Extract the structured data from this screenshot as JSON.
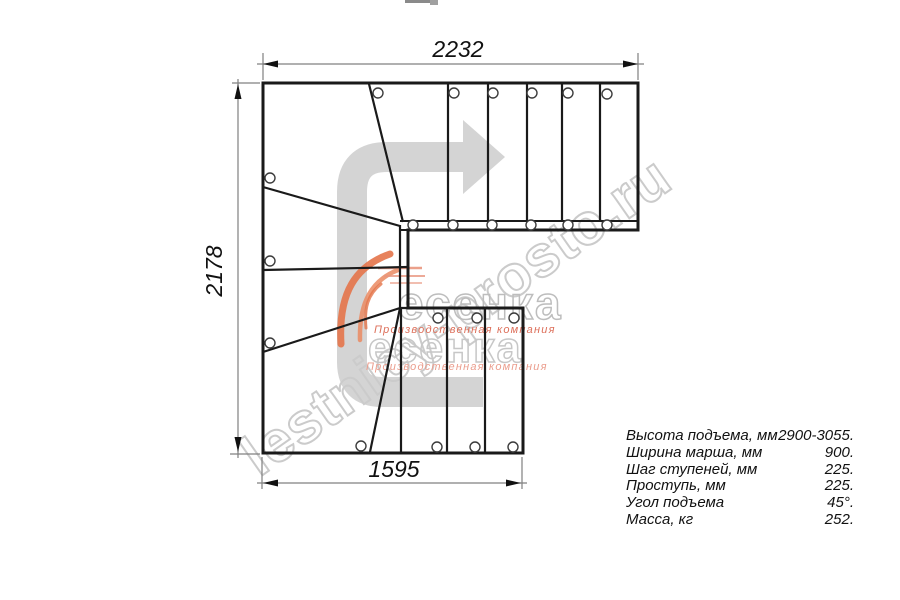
{
  "dimensions": {
    "top": "2232",
    "left": "2178",
    "bottom": "1595"
  },
  "specs": {
    "rows": [
      {
        "label": "Высота подъема, мм",
        "value": "2900-3055."
      },
      {
        "label": "Ширина марша, мм",
        "value": "900."
      },
      {
        "label": "Шаг ступеней, мм",
        "value": "225."
      },
      {
        "label": "Проступь, мм",
        "value": "225."
      },
      {
        "label": "Угол подъема",
        "value": "45°."
      },
      {
        "label": "Масса, кг",
        "value": "252."
      }
    ]
  },
  "watermark": {
    "site": "lestnicy-prosto.ru",
    "brand": "есенка",
    "tagline": "Производственная компания"
  },
  "icons": {
    "direction_arrow": "u-turn-right-arrow",
    "brand_swoosh": "orange-feather-swoosh"
  },
  "colors": {
    "line": "#1a1a1a",
    "dimension": "#808080",
    "arrow_fill": "#d4d4d4",
    "watermark_outline": "#cbcbcb",
    "brand_orange": "#e4744a",
    "tagline_salmon": "#dd6f5a"
  }
}
